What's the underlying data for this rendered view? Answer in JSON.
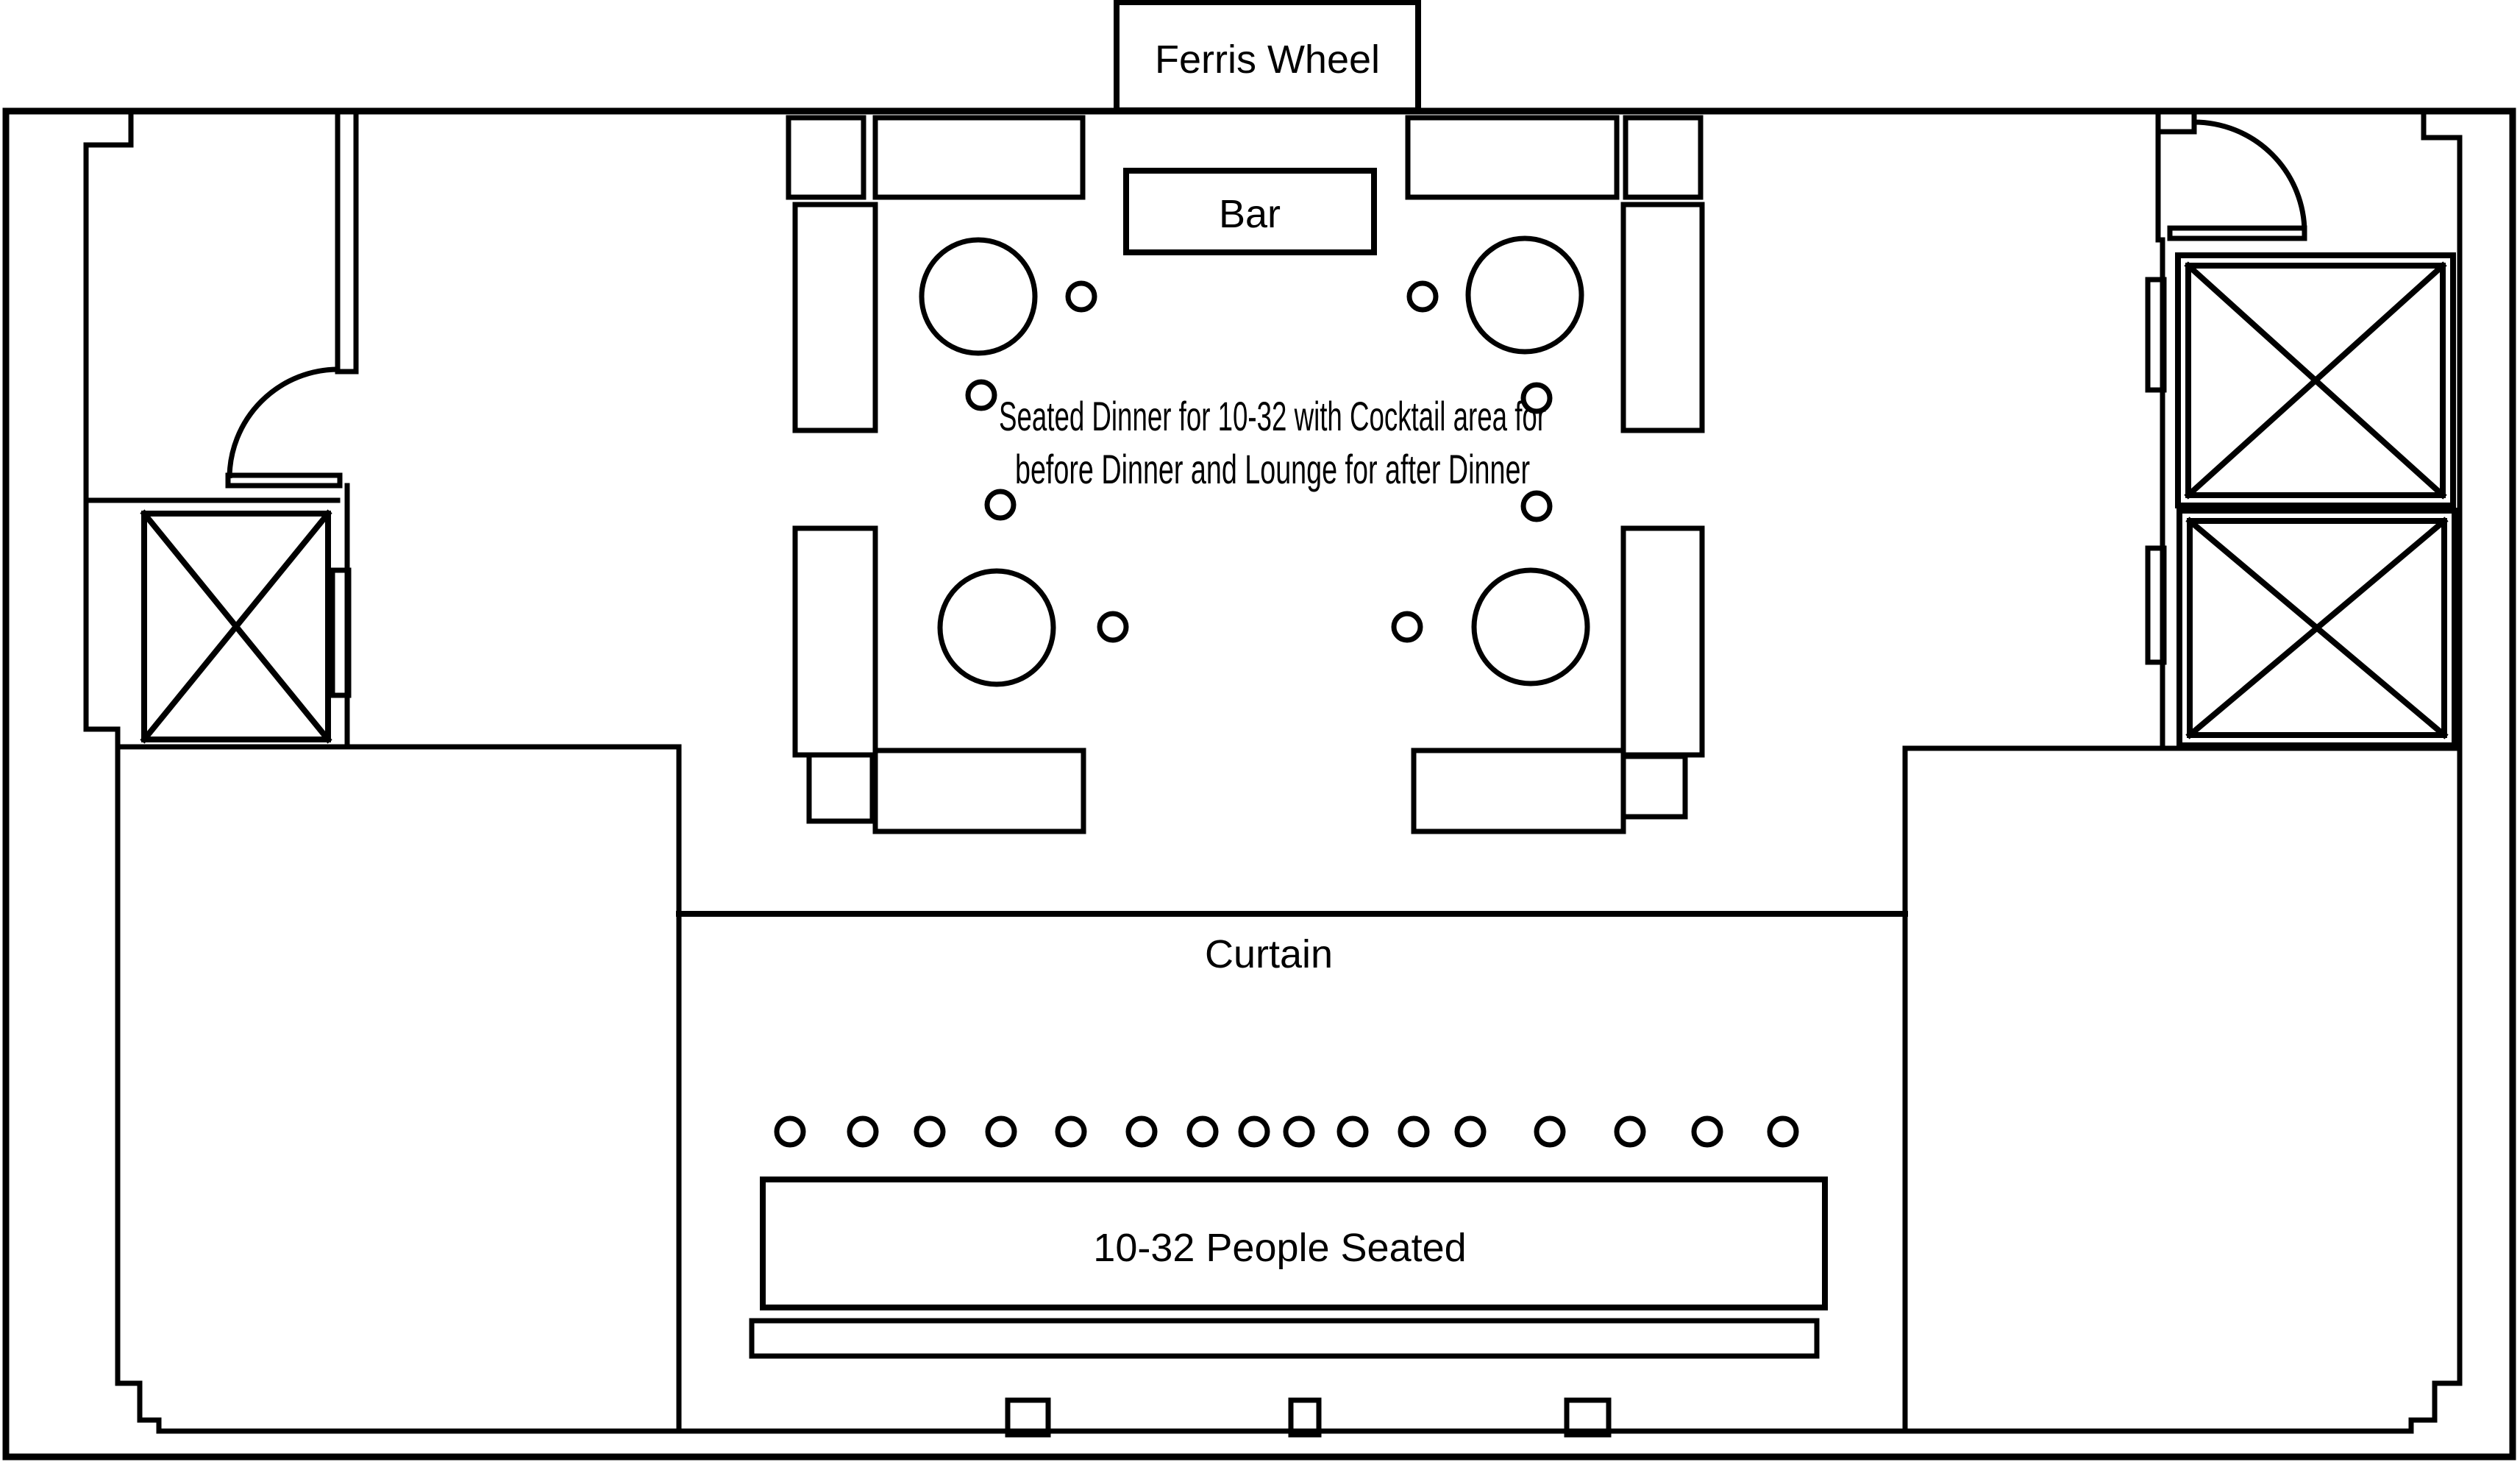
{
  "document": {
    "type": "event-floor-plan",
    "background_color": "#ffffff",
    "line_color": "#000000"
  },
  "labels": {
    "ferris_wheel": "Ferris Wheel",
    "bar": "Bar",
    "note_line1": "Seated Dinner for 10-32 with Cocktail area for",
    "note_line2": "before Dinner and Lounge for after Dinner",
    "curtain": "Curtain",
    "stage": "10-32 People Seated"
  },
  "counts": {
    "round_tables": 4,
    "cocktail_chairs": 8,
    "row_chairs": 16,
    "elevator_shafts": 3,
    "door_swings": 2,
    "lounge_sofas": 8,
    "side_tables": 6
  }
}
